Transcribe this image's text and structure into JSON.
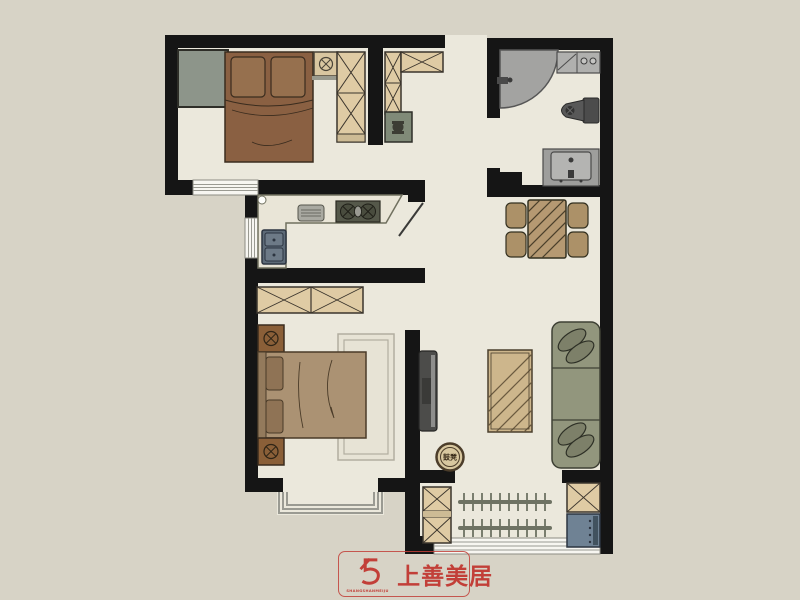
{
  "page": {
    "type": "apartment-floor-plan",
    "background": "#d7d3c6"
  },
  "palette": {
    "wall": "#151515",
    "floor": "#ebe8dc",
    "background": "#d7d3c6",
    "wood_cabinet": "#dfcba4",
    "bed_brown": "#8a6042",
    "bed_master_tan": "#ab9273",
    "sofa_olive": "#92967d",
    "fixture_gray": "#a8a8a6",
    "sink_blue": "#5d6a77",
    "cabinet_blue": "#6f8294",
    "table_wood": "#b59972",
    "cabinet_green": "#8d958a",
    "accent_red": "#c23f38"
  },
  "logo": {
    "brand_text": "上善美居",
    "subtext": "SHANGSHANMEIJU",
    "color": "#c23f38"
  },
  "labels": {
    "drum_stool": "鼓凳"
  },
  "rooms": [
    {
      "id": "bedroom-top",
      "furniture": [
        "green-cabinet",
        "double-bed",
        "nightstand",
        "wardrobe",
        "window"
      ]
    },
    {
      "id": "hallway-study",
      "furniture": [
        "tall-cabinet",
        "top-cabinet",
        "desk-with-chair",
        "entry-opening"
      ]
    },
    {
      "id": "bathroom",
      "furniture": [
        "corner-shower",
        "vanity-sink",
        "toilet",
        "washing-machine"
      ]
    },
    {
      "id": "kitchen",
      "furniture": [
        "l-shaped-counter",
        "double-sink",
        "gas-stove",
        "cutting-board",
        "window",
        "door"
      ]
    },
    {
      "id": "dining-area",
      "furniture": [
        "dining-table",
        "chair",
        "chair",
        "chair",
        "chair"
      ]
    },
    {
      "id": "master-bedroom",
      "furniture": [
        "wardrobe",
        "double-bed",
        "nightstand",
        "nightstand",
        "rug",
        "bay-window"
      ]
    },
    {
      "id": "living-room",
      "furniture": [
        "wall-tv",
        "coffee-table",
        "sofa",
        "drum-stool"
      ]
    },
    {
      "id": "balcony",
      "furniture": [
        "storage-cabinet",
        "storage-cabinet",
        "blue-cabinet",
        "drying-rack",
        "drying-rack",
        "window"
      ]
    }
  ]
}
